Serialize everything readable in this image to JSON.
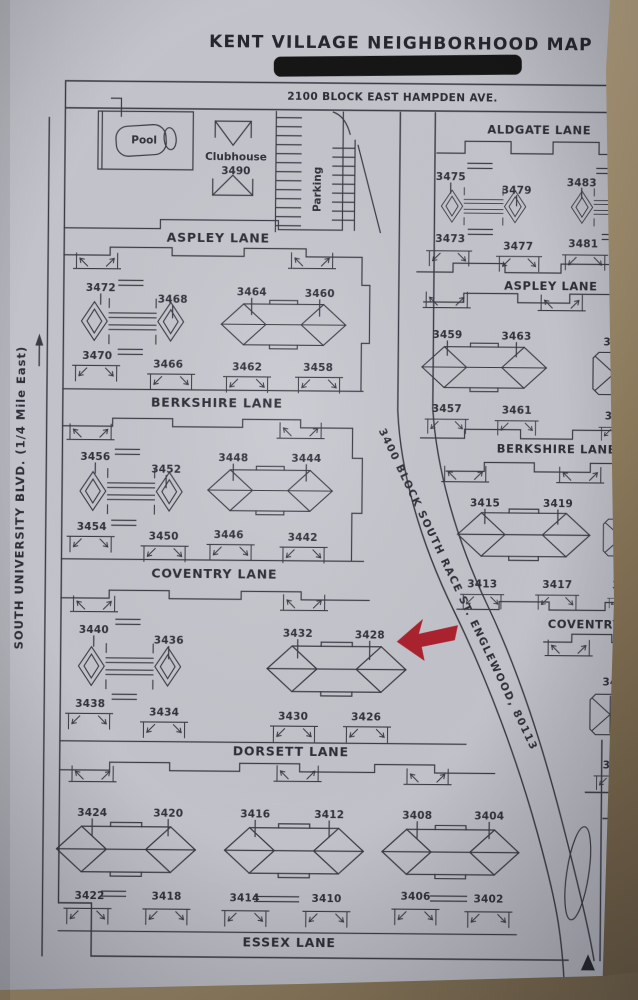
{
  "colors": {
    "paper": "#c2c2ca",
    "ink": "#3a3a44",
    "table_edge": "#8f7c5e",
    "redaction": "#191919",
    "arrow": "#ab202e"
  },
  "title": "KENT VILLAGE NEIGHBORHOOD MAP",
  "streets": {
    "hampden": "2100 BLOCK EAST HAMPDEN AVE.",
    "aldgate": "ALDGATE LANE",
    "aspley_left": "ASPLEY LANE",
    "aspley_right": "ASPLEY LANE",
    "berkshire_left": "BERKSHIRE LANE",
    "berkshire_right": "BERKSHIRE LANE",
    "coventry_left": "COVENTRY LANE",
    "coventry_right": "COVENTRY LANE",
    "dorsett": "DORSETT LANE",
    "dorsett_right_partial": "DOR",
    "essex": "ESSEX LANE",
    "race": "3400 BLOCK SOUTH RACE ST. ENGLEWOOD, 80113",
    "university": "SOUTH UNIVERSITY BLVD. (1/4 Mile East)"
  },
  "amenities": {
    "pool": "Pool",
    "clubhouse": "Clubhouse",
    "clubhouse_number": "3490",
    "parking": "Parking"
  },
  "blocks": {
    "aldgate_aspley": {
      "top": [
        "3475",
        "3479",
        "3483"
      ],
      "bottom": [
        "3473",
        "3477",
        "3481"
      ]
    },
    "aspley_berkshire_left": {
      "top": [
        "3472",
        "3468",
        "3464",
        "3460"
      ],
      "bottom": [
        "3470",
        "3466",
        "3462",
        "3458"
      ]
    },
    "aspley_berkshire_right": {
      "top": [
        "3459",
        "3463",
        "3467"
      ],
      "bottom": [
        "3457",
        "3461",
        "3465"
      ]
    },
    "berkshire_coventry_left": {
      "top": [
        "3456",
        "3452",
        "3448",
        "3444"
      ],
      "bottom": [
        "3454",
        "3450",
        "3446",
        "3442"
      ]
    },
    "berkshire_coventry_right": {
      "top": [
        "3415",
        "3419",
        "3423"
      ],
      "bottom": [
        "3413",
        "3417",
        "3421"
      ]
    },
    "coventry_dorsett_left": {
      "top": [
        "3440",
        "3436",
        "3432",
        "3428"
      ],
      "bottom": [
        "3438",
        "3434",
        "3430",
        "3426"
      ]
    },
    "coventry_dorsett_right": {
      "top": [
        "3407"
      ],
      "bottom": [
        "3405"
      ]
    },
    "dorsett_essex": {
      "top": [
        "3424",
        "3420",
        "3416",
        "3412",
        "3408",
        "3404"
      ],
      "bottom": [
        "3422",
        "3418",
        "3414",
        "3410",
        "3406",
        "3402"
      ]
    },
    "partial_east_number": "34"
  },
  "marker": {
    "points_to": "3428"
  }
}
